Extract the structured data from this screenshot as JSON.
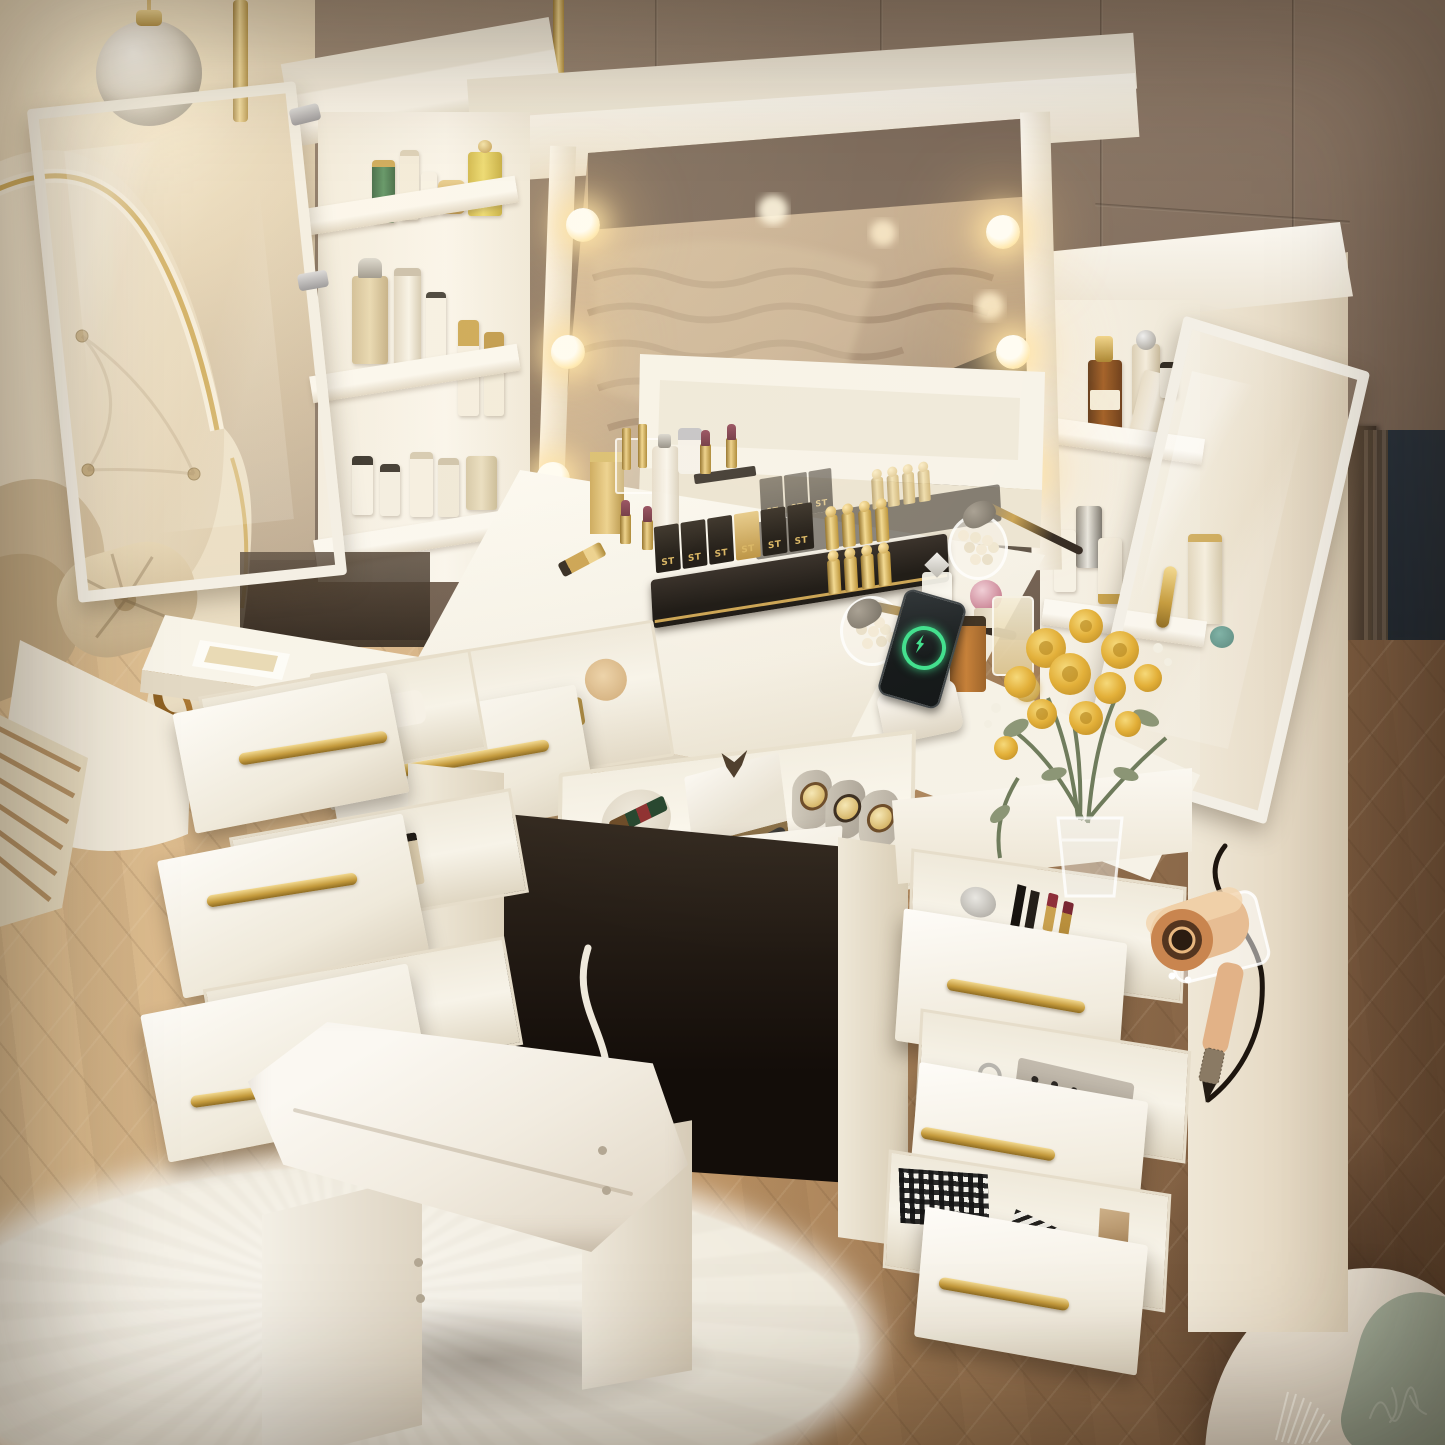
{
  "scene": {
    "type": "product-photograph",
    "subject": "White hollywood-style LED vanity dressing table set with lighted mirror, two glass-door storage cabinets, eight open gold-handled drawers, flip-top organizer desktop and cushioned stool",
    "setting": "Warm luxury bedroom at night beside a floor-to-ceiling window with city bokeh lights",
    "camera": "high three-quarter aerial view"
  },
  "labels": {
    "lipstick_organizer_monogram": "ST"
  },
  "counts": {
    "mirror_led_bulbs_visible": 6,
    "open_drawers": 8,
    "glass_door_cabinets": 2,
    "wall_lamp_globes": 2,
    "watches_in_drawer": 3
  },
  "palette": {
    "furniture_white": "#f7f3ea",
    "hardware_gold": "#c9a24a",
    "wall_taupe": "#7c685a",
    "accent_wall_cream": "#e7d9bd",
    "floor_light_oak": "#d7b387",
    "floor_dark_walnut": "#7c5d42",
    "window_night": "#1a222b",
    "rug_white": "#f4f1ea",
    "bed_cream_leather": "#ecdfc8",
    "pillow_tan": "#cdb794",
    "sage_cushion": "#98a38f",
    "rose_yellow": "#e6b93f",
    "hairdryer_rose_gold": "#e0a97e",
    "charging_ring_green": "#3adf8a",
    "lipstick_plum": "#7e3b46"
  },
  "objects": [
    {
      "name": "vanity-desk",
      "detail": "white desktop bridging two drawer pedestals"
    },
    {
      "name": "hollywood-mirror",
      "detail": "large mirror reflecting beige textured bedding and dark marble"
    },
    {
      "name": "led-bulbs",
      "detail": "warm glowing globe bulbs along both mirror edges"
    },
    {
      "name": "left-glass-cabinet",
      "detail": "open glazed door, three shelves of skincare and perfume bottles"
    },
    {
      "name": "right-glass-cabinet",
      "detail": "open glazed door with gold handle, serum and lotion bottles"
    },
    {
      "name": "lipstick-organizer",
      "detail": "black and gold ST monogram holder with rows of gold bullet lipsticks"
    },
    {
      "name": "acrylic-lipstick-stand",
      "detail": "clear riser with gold tubes and plum open lipsticks"
    },
    {
      "name": "pearl-jars-with-brushes",
      "detail": "two glass jars filled with pearls holding makeup brushes"
    },
    {
      "name": "perfume-cluster",
      "detail": "amber square bottle, pink sphere atomizer, crystal-cap and gold bottles"
    },
    {
      "name": "smartphone-charging-dock",
      "detail": "black phone on white stand showing green charging ring"
    },
    {
      "name": "rose-bouquet",
      "detail": "yellow roses with eucalyptus in a glass vase on right pedestal"
    },
    {
      "name": "hair-dryer",
      "detail": "rose-gold dryer on clear side mount with black cord"
    },
    {
      "name": "center-drawer-jewelry",
      "detail": "watch gift box, striped belt roll, three gold watches on gray pillows"
    },
    {
      "name": "upper-drawer-makeup",
      "detail": "cream jars, compacts and powder inside open drawer"
    },
    {
      "name": "left-pedestal-drawers",
      "detail": "three open drawers with sponges, bottles and magazines"
    },
    {
      "name": "right-pedestal-drawers",
      "detail": "three open drawers with lipsticks, stud earrings on felt, patterned gift boxes"
    },
    {
      "name": "vanity-stool",
      "detail": "white cushioned stool with panel legs on shag rug"
    },
    {
      "name": "shag-rug",
      "detail": "fluffy white area rug"
    },
    {
      "name": "herringbone-floor",
      "detail": "light oak to dark walnut parquet"
    },
    {
      "name": "bed",
      "detail": "cream tufted headboard with gold trim, tan pillows, button bolster, carved gold ornament"
    },
    {
      "name": "striped-throw",
      "detail": "tan and cream striped blanket corner"
    },
    {
      "name": "panel-wall",
      "detail": "taupe brown wall panels with vertical seams"
    },
    {
      "name": "night-window",
      "detail": "dark glass with orange and teal city bokeh"
    },
    {
      "name": "globe-lamps",
      "detail": "two glowing sphere lamps on gold arms by the window"
    },
    {
      "name": "marble-pendant-lamp",
      "detail": "glowing marble ball pendant, top left"
    },
    {
      "name": "armchair",
      "detail": "cream chair with sage green cushion and white fringe throw, bottom right"
    },
    {
      "name": "power-cord",
      "detail": "white cable dropping from the center drawer"
    },
    {
      "name": "artist-signature",
      "detail": "faint pale scribble watermark near bottom right"
    }
  ]
}
